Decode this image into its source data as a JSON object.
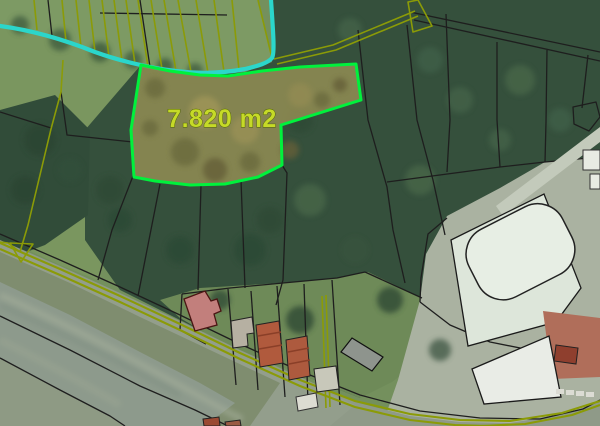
{
  "map": {
    "parcel": {
      "area_label": "7.820 m2"
    },
    "colors": {
      "parcel_outline": "#00f13c",
      "parcel_fill": "#8d8a52",
      "area_label": "#c6da28",
      "stream": "#2bd6cb",
      "road_edge": "#8b9b07",
      "cadastral_boundary": "#1e1e1e",
      "meadow": "#7d9a64",
      "forest": "#35503c",
      "corridor_water": "#8d9a8c",
      "highlight_house": "#c27f7c",
      "red_roof": "#b05a3d"
    }
  }
}
